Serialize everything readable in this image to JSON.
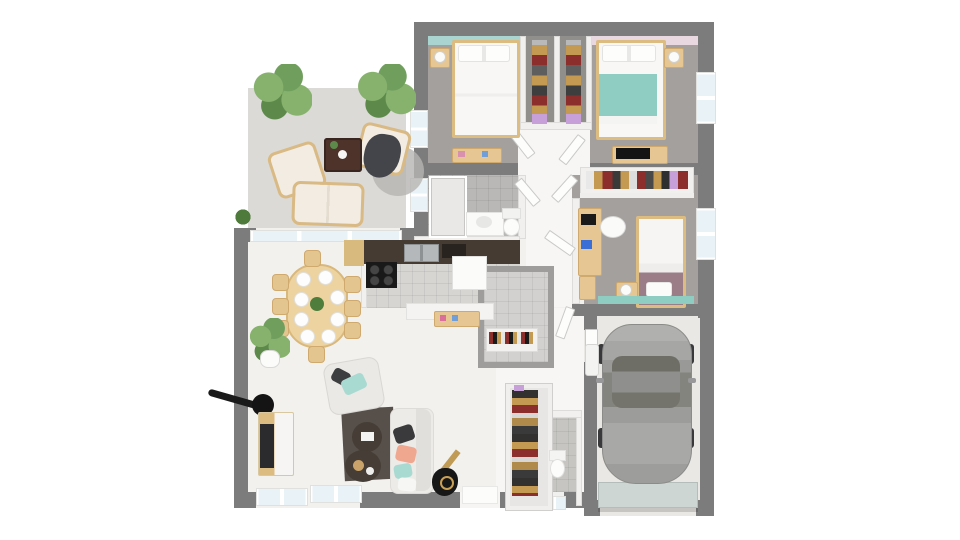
{
  "scene": {
    "description": "3D rendered top-down floor plan of a single-storey house with terrace, three bedrooms, bathroom, kitchen, living-dining room, entry, WC, pantry and garage with a parked car",
    "view": "top-down isometric render",
    "background": "#ffffff"
  },
  "palette": {
    "wall": "#7c7c7c",
    "partition": "#f1f0ee",
    "terrace-floor": "#dcdad6",
    "bedroom-floor": "#a3a09e",
    "closet-floor": "#918f8c",
    "bath-tile": "#b9b8b6",
    "kitchen-tile": "#d6d5d2",
    "pantry-tile": "#d2d1cf",
    "wc-tile": "#c6c5c2",
    "living-floor": "#f3f1ee",
    "hall-floor": "#f7f6f4",
    "garage-floor": "#eae8e4",
    "accent-teal": "#a9d4cf",
    "accent-pink": "#e9d8df",
    "blanket-teal": "#8fcdc3",
    "bed-mauve": "#9b7d88",
    "wood": "#dcbc80",
    "wood-light": "#e6c793",
    "counter": "#463b33",
    "stove": "#191919",
    "steel": "#b5b8bb",
    "fridge": "#fbfbf9",
    "rug": "#57504a",
    "sofa": "#edebe7",
    "pillow-dark": "#3a3a3c",
    "pillow-salmon": "#efa78f",
    "pillow-teal": "#a9dad2",
    "plant-green": "#6f9e5d",
    "car-body": "#a6a6a4",
    "car-glass": "#75756e",
    "garage-door": "#ced6d3",
    "glass": "#e9f2f6",
    "clothes-tan": "#c49a52",
    "clothes-red": "#8c2f2c",
    "clothes-gray": "#5e5e5e",
    "clothes-purple": "#c79fd9"
  },
  "rooms": [
    {
      "name": "terrace",
      "items": [
        "potted-plant",
        "potted-plant",
        "armchair",
        "armchair-with-throw",
        "loveseat",
        "serving-cart",
        "round-rug",
        "bush"
      ]
    },
    {
      "name": "bedroom-1",
      "accent": "teal",
      "items": [
        "double-bed",
        "nightstand",
        "lamp",
        "desk"
      ]
    },
    {
      "name": "wardrobe-closets",
      "items": [
        "hanging-clothes",
        "hanging-clothes"
      ]
    },
    {
      "name": "bedroom-2",
      "accent": "pink",
      "items": [
        "double-bed-teal-blanket",
        "nightstand",
        "lamp",
        "desk-with-keyboard"
      ]
    },
    {
      "name": "bedroom-3",
      "items": [
        "single-bed",
        "desk",
        "laptop",
        "chair",
        "closet-with-clothes",
        "nightstand",
        "lamp"
      ]
    },
    {
      "name": "bathroom",
      "items": [
        "shower",
        "vanity-sink",
        "toilet"
      ]
    },
    {
      "name": "hallway",
      "items": [
        "doors"
      ]
    },
    {
      "name": "kitchen",
      "items": [
        "counter",
        "double-sink",
        "coffee-machine",
        "cooktop",
        "fridge",
        "island",
        "spice-shelf"
      ]
    },
    {
      "name": "pantry",
      "items": [
        "storage-shelf"
      ]
    },
    {
      "name": "dining-area",
      "items": [
        "dining-table",
        "eight-place-settings",
        "chairs",
        "potted-plant"
      ]
    },
    {
      "name": "living-room",
      "items": [
        "tv-cabinet",
        "tv",
        "arc-floor-lamp",
        "armchair",
        "rug",
        "coffee-table",
        "coffee-table",
        "sofa",
        "guitar",
        "windows"
      ]
    },
    {
      "name": "entry",
      "items": [
        "shoe-cabinet",
        "doormat",
        "front-door"
      ]
    },
    {
      "name": "wc",
      "items": [
        "toilet",
        "window"
      ]
    },
    {
      "name": "garage",
      "items": [
        "car",
        "garage-door",
        "water-heater",
        "service-door"
      ]
    }
  ]
}
